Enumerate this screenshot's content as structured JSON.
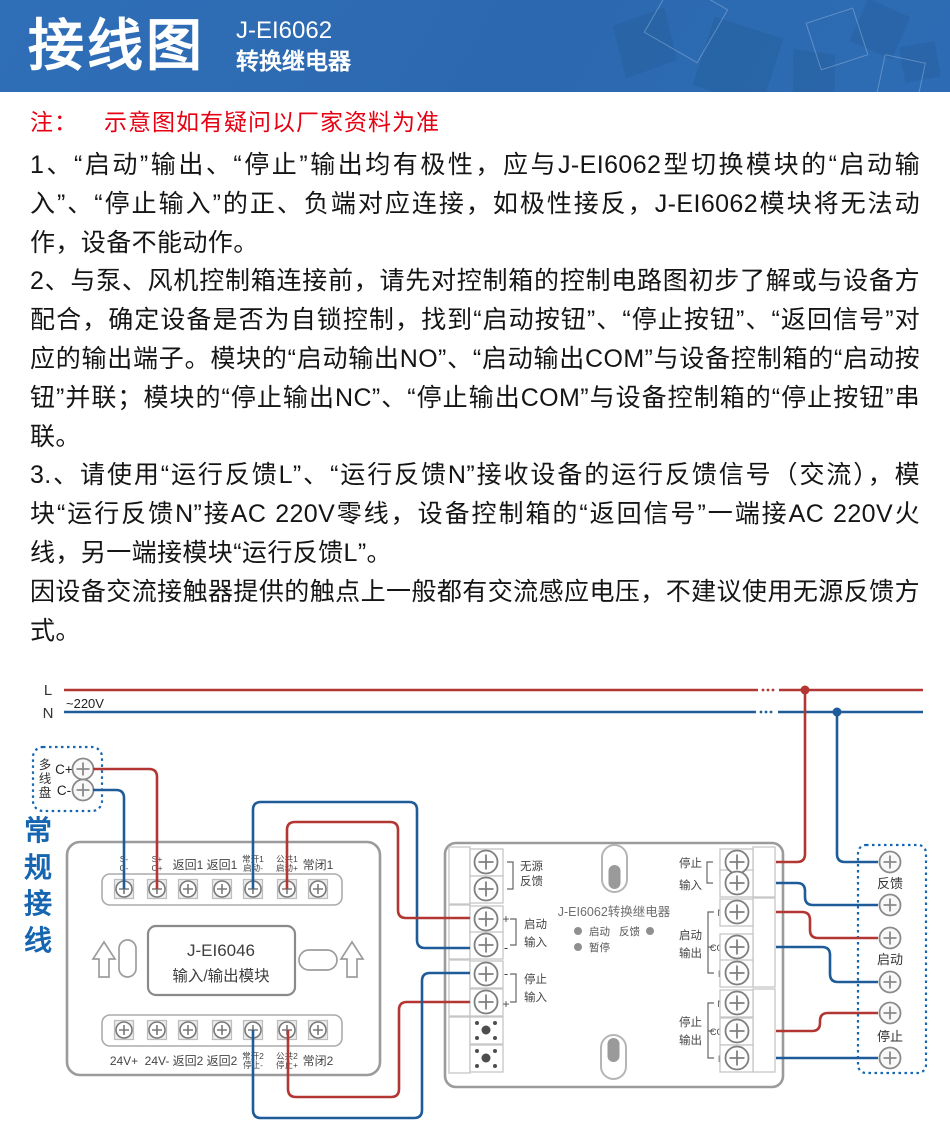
{
  "header": {
    "title": "接线图",
    "model": "J-EI6062",
    "subtitle": "转换继电器"
  },
  "note": {
    "prefix": "注：",
    "text": "示意图如有疑问以厂家资料为准"
  },
  "paragraphs": [
    "1、“启动”输出、“停止”输出均有极性，应与J-EI6062型切换模块的“启动输入”、“停止输入”的正、负端对应连接，如极性接反，J-EI6062模块将无法动作，设备不能动作。",
    "2、与泵、风机控制箱连接前，请先对控制箱的控制电路图初步了解或与设备方配合，确定设备是否为自锁控制，找到“启动按钮”、“停止按钮”、“返回信号”对应的输出端子。模块的“启动输出NO”、“启动输出COM”与设备控制箱的“启动按钮”并联；模块的“停止输出NC”、“停止输出COM”与设备控制箱的“停止按钮”串联。",
    "3.、请使用“运行反馈L”、“运行反馈N”接收设备的运行反馈信号（交流），模块“运行反馈N”接AC 220V零线，设备控制箱的“返回信号”一端接AC 220V火线，另一端接模块“运行反馈L”。",
    "因设备交流接触器提供的触点上一般都有交流感应电压，不建议使用无源反馈方式。"
  ],
  "diagram": {
    "bus": {
      "l": "L",
      "n": "N",
      "voltage": "~220V"
    },
    "panel": {
      "c1": "多",
      "c2": "线",
      "c3": "盘",
      "t1": "C+",
      "t2": "C-"
    },
    "section": {
      "c1": "常",
      "c2": "规",
      "c3": "接",
      "c4": "线"
    },
    "m46": {
      "name": "J-EI6046",
      "subname": "输入/输出模块",
      "top": [
        {
          "l1": "S-",
          "l2": "C-"
        },
        {
          "l1": "S+",
          "l2": "C+"
        },
        {
          "l1": "返回1"
        },
        {
          "l1": "返回1"
        },
        {
          "l1": "常开1",
          "l2": "启动-"
        },
        {
          "l1": "公共1",
          "l2": "启动+"
        },
        {
          "l1": "常闭1"
        }
      ],
      "bottom": [
        {
          "l1": "24V+"
        },
        {
          "l1": "24V-"
        },
        {
          "l1": "返回2"
        },
        {
          "l1": "返回2"
        },
        {
          "l1": "常开2",
          "l2": "停止-"
        },
        {
          "l1": "公共2",
          "l2": "停止+"
        },
        {
          "l1": "常闭2"
        }
      ]
    },
    "m62": {
      "name": "J-EI6062转换继电器",
      "led_start": "启动",
      "led_feedback": "反馈",
      "led_pause": "暂停",
      "g_passive": {
        "l1": "无源",
        "l2": "反馈"
      },
      "g_start_in": {
        "l1": "启动",
        "l2": "输入",
        "s_top": "+",
        "s_bottom": "-"
      },
      "g_stop_in": {
        "l1": "停止",
        "l2": "输入",
        "s_top": "-",
        "s_bottom": "+"
      },
      "g_ac": {
        "l1": "停止",
        "l2": "输入",
        "t1": "L",
        "t2": "N"
      },
      "g_start_out": {
        "l1": "启动",
        "l2": "输出",
        "t1": "NO",
        "t2": "COM",
        "t3": "NC"
      },
      "g_stop_out": {
        "l1": "停止",
        "l2": "输出",
        "t1": "NO",
        "t2": "COM",
        "t3": "NC"
      }
    },
    "device": {
      "feedback": "反馈",
      "start": "启动",
      "stop": "停止"
    },
    "colors": {
      "live_wire": "#b23632",
      "neutral_wire": "#1e5c99",
      "accent_blue": "#1565b0",
      "note_red": "#e60012",
      "header_blue": "#2d6cb4"
    }
  }
}
